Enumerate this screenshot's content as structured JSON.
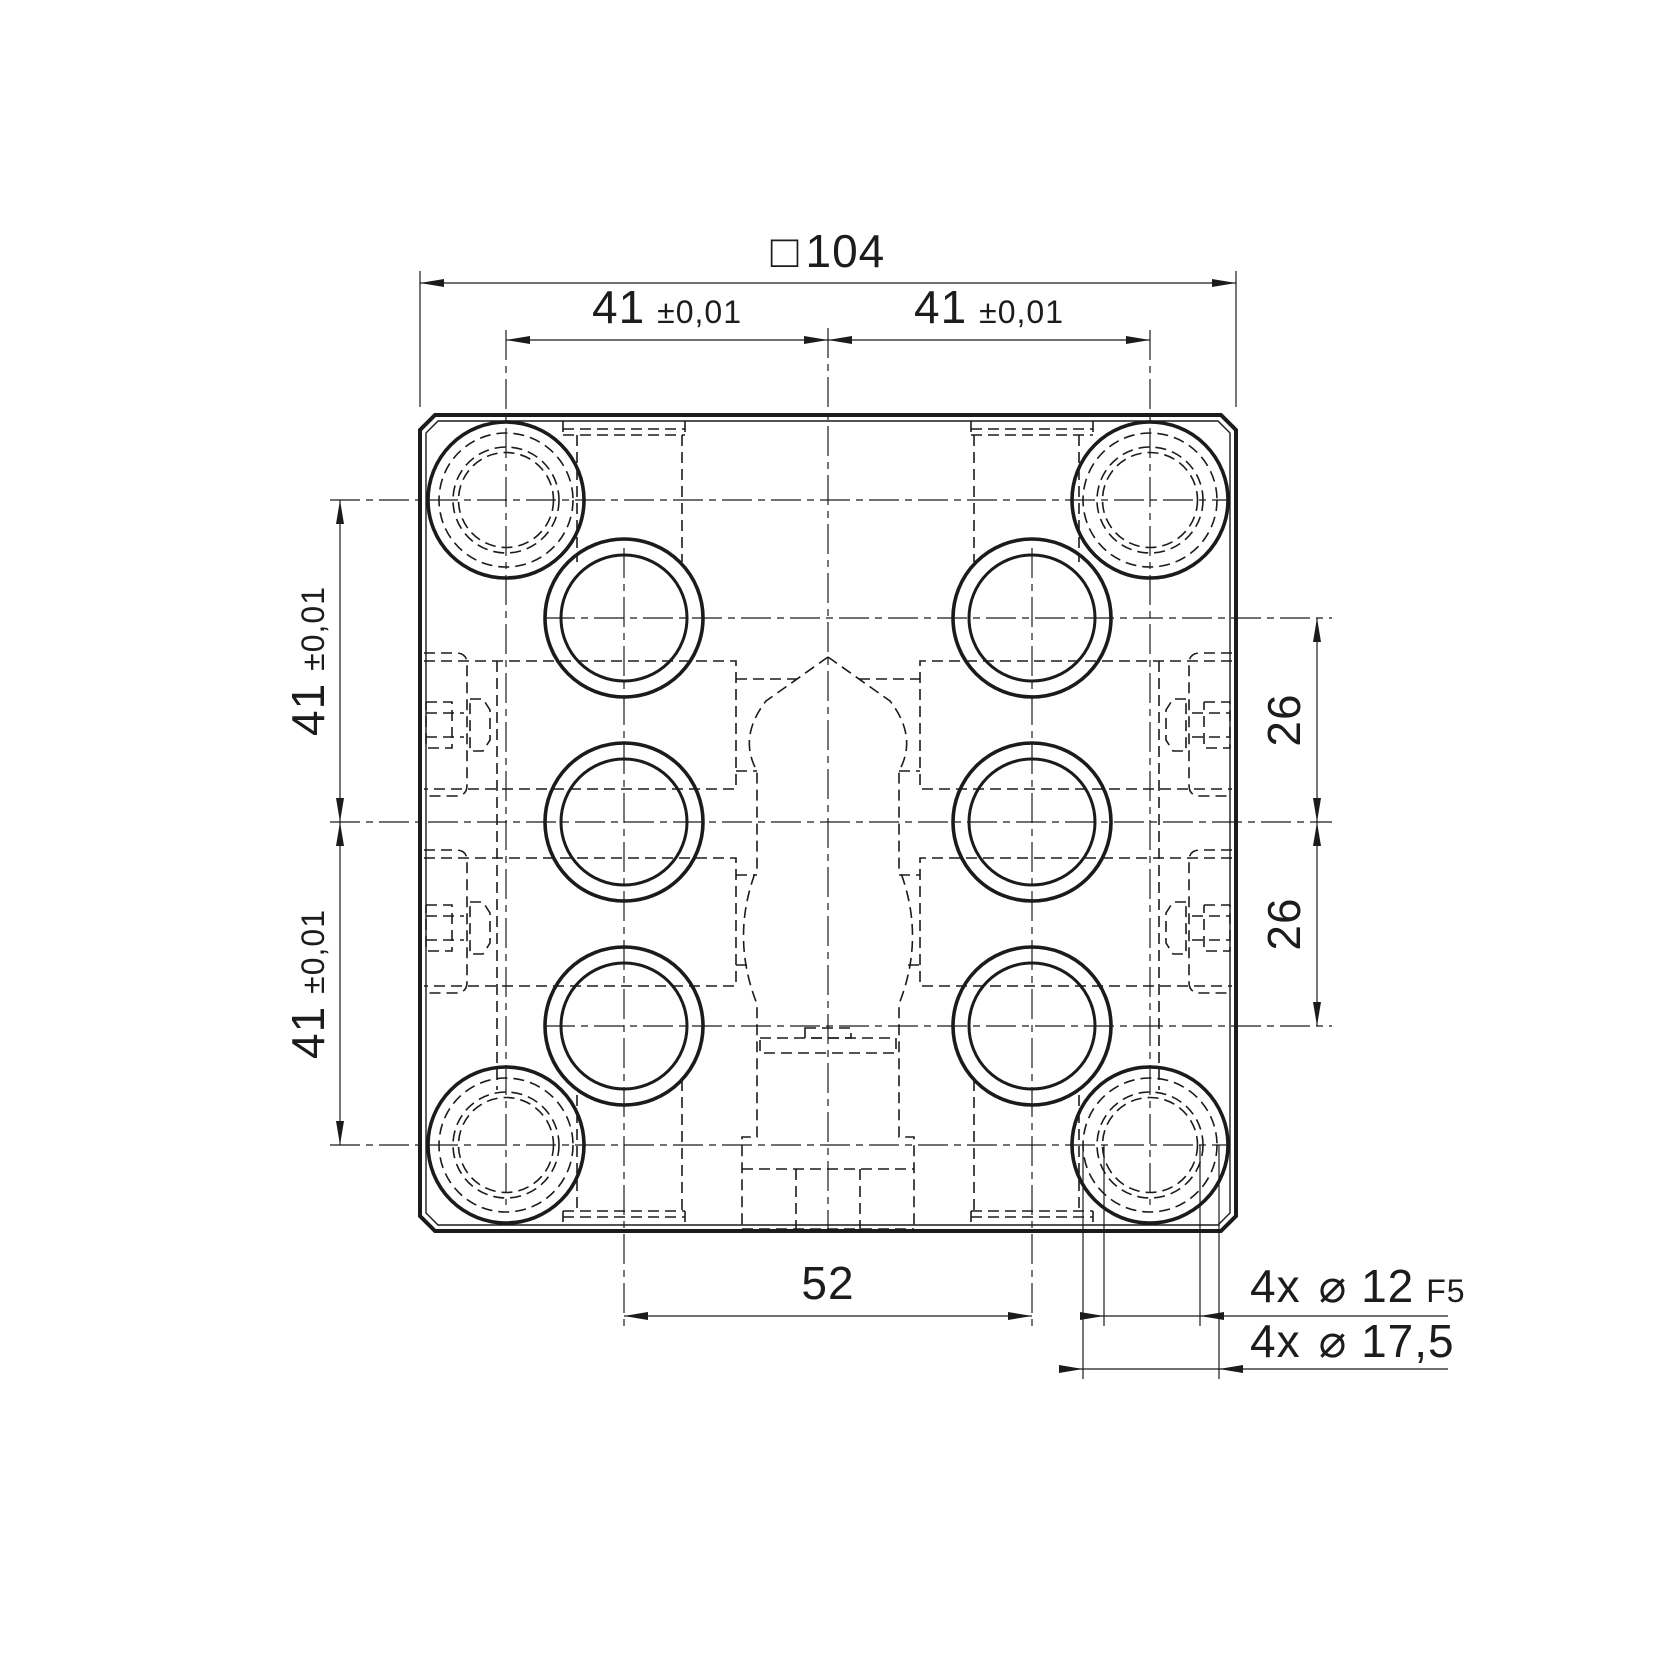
{
  "drawing": {
    "type": "technical-drawing-top-view",
    "background_color": "#ffffff",
    "line_color": "#1b1b1b",
    "dimensions": {
      "overall_width": {
        "prefix": "□",
        "value": "104"
      },
      "hole_spacing_top_left": {
        "value": "41",
        "tolerance": "±0,01"
      },
      "hole_spacing_top_right": {
        "value": "41",
        "tolerance": "±0,01"
      },
      "hole_spacing_left_upper": {
        "value": "41",
        "tolerance": "±0,01"
      },
      "hole_spacing_left_lower": {
        "value": "41",
        "tolerance": "±0,01"
      },
      "port_spacing_right_upper": {
        "value": "26"
      },
      "port_spacing_right_lower": {
        "value": "26"
      },
      "port_spacing_bottom": {
        "value": "52"
      },
      "mounting_hole": {
        "qty": "4x",
        "diameter": "⌀ 12",
        "fit": "F5"
      },
      "counterbore": {
        "qty": "4x",
        "diameter": "⌀ 17,5"
      }
    }
  }
}
